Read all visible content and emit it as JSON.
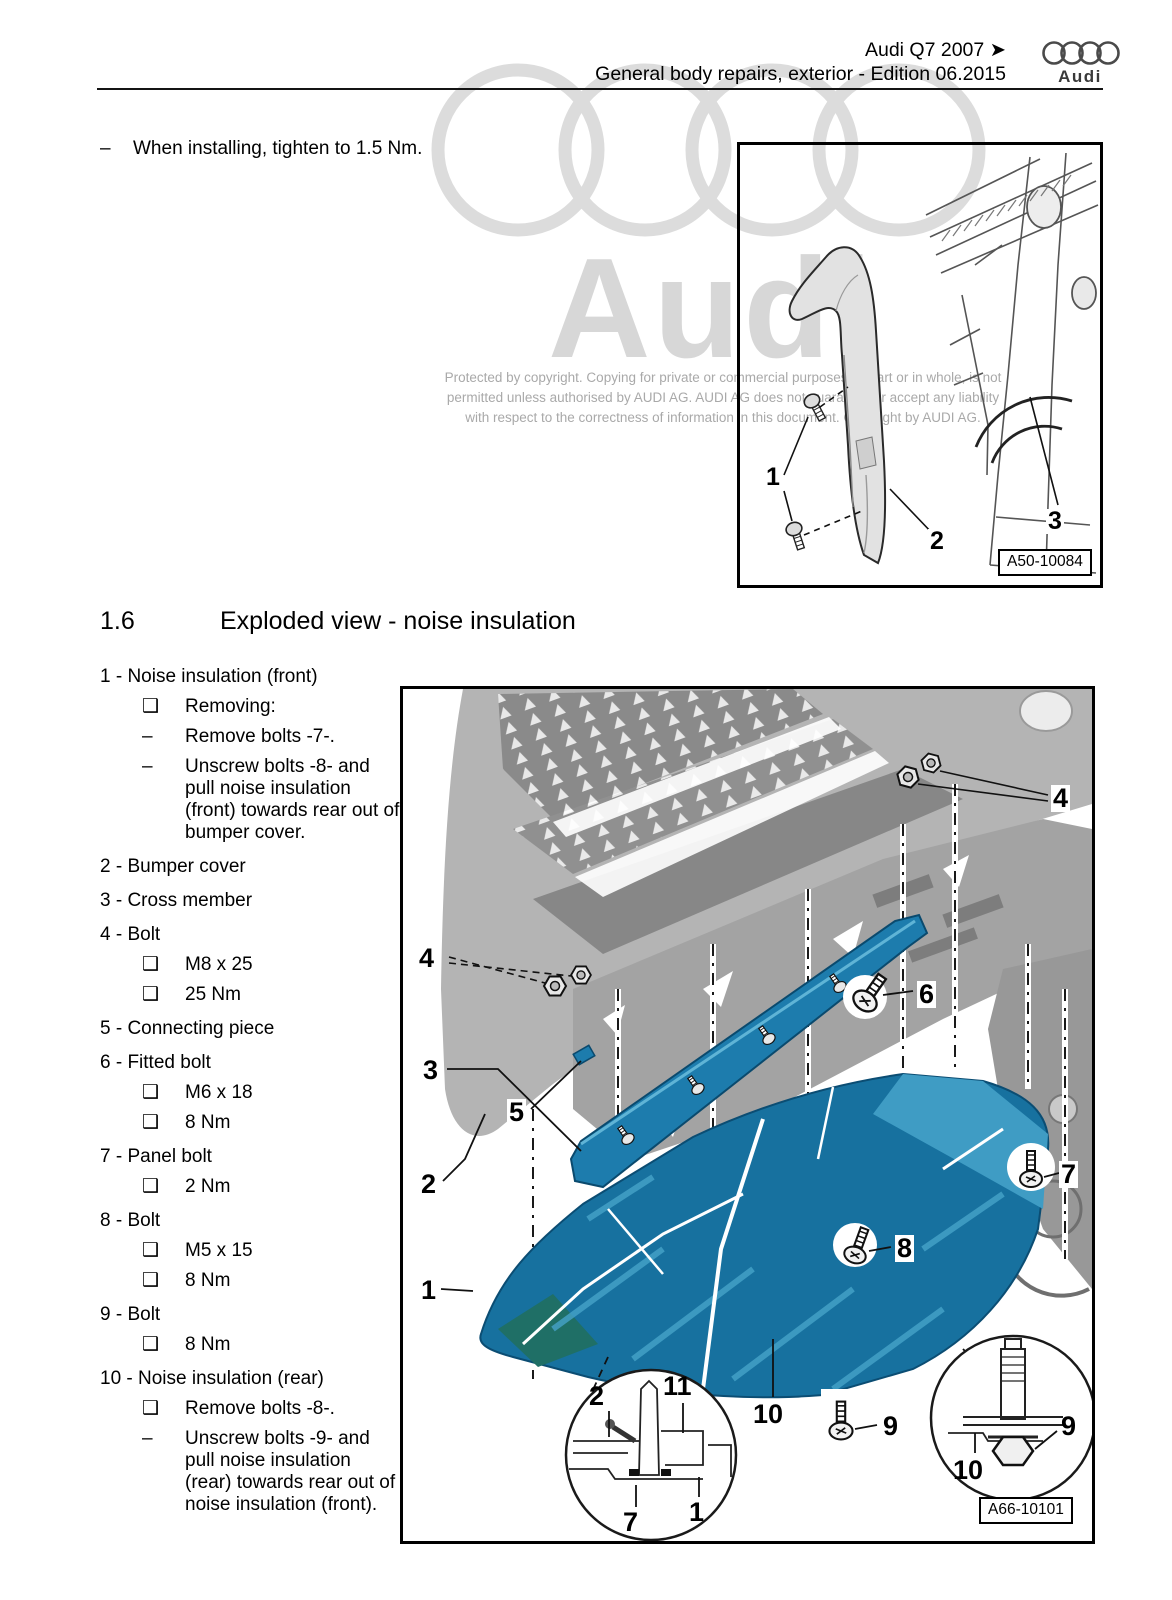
{
  "header": {
    "model_line": "Audi Q7 2007 ➤",
    "doc_line": "General body repairs, exterior - Edition 06.2015",
    "brand": "Audi"
  },
  "watermark": {
    "brand": "Audi",
    "copyright_lines": [
      "Protected by copyright. Copying for private or commercial purposes, in part or in whole, is not",
      "permitted unless authorised by AUDI AG. AUDI AG does not guarantee or accept any liability",
      "with respect to the correctness of information in this document. Copyright by AUDI AG."
    ]
  },
  "note": {
    "marker": "–",
    "text": "When installing, tighten to 1.5 Nm."
  },
  "section": {
    "number": "1.6",
    "title": "Exploded view - noise insulation"
  },
  "fig_top": {
    "callouts": {
      "c1": "1",
      "c2": "2",
      "c3": "3"
    },
    "ref": "A50-10084"
  },
  "parts": [
    {
      "label": "1 - Noise insulation (front)",
      "details": [
        {
          "bullet": "❑",
          "text": "Removing:"
        },
        {
          "bullet": "–",
          "text": "Remove bolts -7-."
        },
        {
          "bullet": "–",
          "text": "Unscrew bolts -8- and pull noise insulation (front) towards rear out of bumper cover."
        }
      ]
    },
    {
      "label": "2 - Bumper cover",
      "details": []
    },
    {
      "label": "3 - Cross member",
      "details": []
    },
    {
      "label": "4 - Bolt",
      "details": [
        {
          "bullet": "❑",
          "text": "M8 x 25"
        },
        {
          "bullet": "❑",
          "text": "25 Nm"
        }
      ]
    },
    {
      "label": "5 - Connecting piece",
      "details": []
    },
    {
      "label": "6 - Fitted bolt",
      "details": [
        {
          "bullet": "❑",
          "text": "M6 x 18"
        },
        {
          "bullet": "❑",
          "text": "8 Nm"
        }
      ]
    },
    {
      "label": "7 - Panel bolt",
      "details": [
        {
          "bullet": "❑",
          "text": "2 Nm"
        }
      ]
    },
    {
      "label": "8 - Bolt",
      "details": [
        {
          "bullet": "❑",
          "text": "M5 x 15"
        },
        {
          "bullet": "❑",
          "text": "8 Nm"
        }
      ]
    },
    {
      "label": "9 - Bolt",
      "details": [
        {
          "bullet": "❑",
          "text": "8 Nm"
        }
      ]
    },
    {
      "label": "10 - Noise insulation (rear)",
      "details": [
        {
          "bullet": "❑",
          "text": "Remove bolts -8-."
        },
        {
          "bullet": "–",
          "text": "Unscrew bolts -9- and pull noise insulation (rear) towards rear out of noise insulation (front)."
        }
      ]
    }
  ],
  "fig_main": {
    "callouts": {
      "r4": "4",
      "l4": "4",
      "n6": "6",
      "n3": "3",
      "n5": "5",
      "n2": "2",
      "n1": "1",
      "n7": "7",
      "n8": "8",
      "n10": "10",
      "n9": "9",
      "il2": "2",
      "il11": "11",
      "il7": "7",
      "il1": "1",
      "ir10": "10",
      "ir9": "9"
    },
    "ref": "A66-10101"
  },
  "colors": {
    "insulation_blue": "#17719f",
    "insulation_light_blue": "#3f9cc4",
    "cross_member_blue": "#1d7cad",
    "teal_accent": "#1f6f66",
    "body_gray": "#b4b4b4",
    "watermark_gray": "#d7d7d7"
  }
}
